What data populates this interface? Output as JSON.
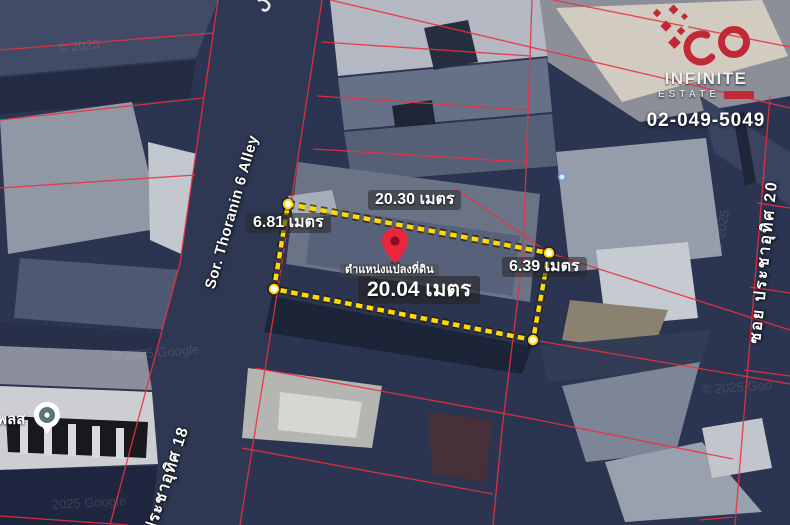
{
  "measurements": {
    "top": "20.30 เมตร",
    "left": "6.81 เมตร",
    "right": "6.39 เมตร",
    "bottom": "20.04 เมตร",
    "pin_caption": "ตำแหน่งแปลงที่ดิน"
  },
  "streets": {
    "alley": "Sor. Thoranin 6 Alley",
    "road_left": "ประชาอุทิศ 18",
    "road_right": "ซอย ประชาอุทิศ 20"
  },
  "place": {
    "label": "เพลส"
  },
  "branding": {
    "line1": "INFINITE",
    "line2": "ESTATE",
    "phone": "02-049-5049"
  },
  "watermarks": [
    "© 2025",
    "© 2025 Google",
    "© 2025 Goo",
    "2025 Google",
    "© 2025"
  ],
  "colors": {
    "parcel_line": "#ee2f3e",
    "plot_outline": "#ffd900",
    "pin": "#e8273d",
    "brand_red": "#c22936",
    "place_marker_inner": "#5e7277"
  }
}
